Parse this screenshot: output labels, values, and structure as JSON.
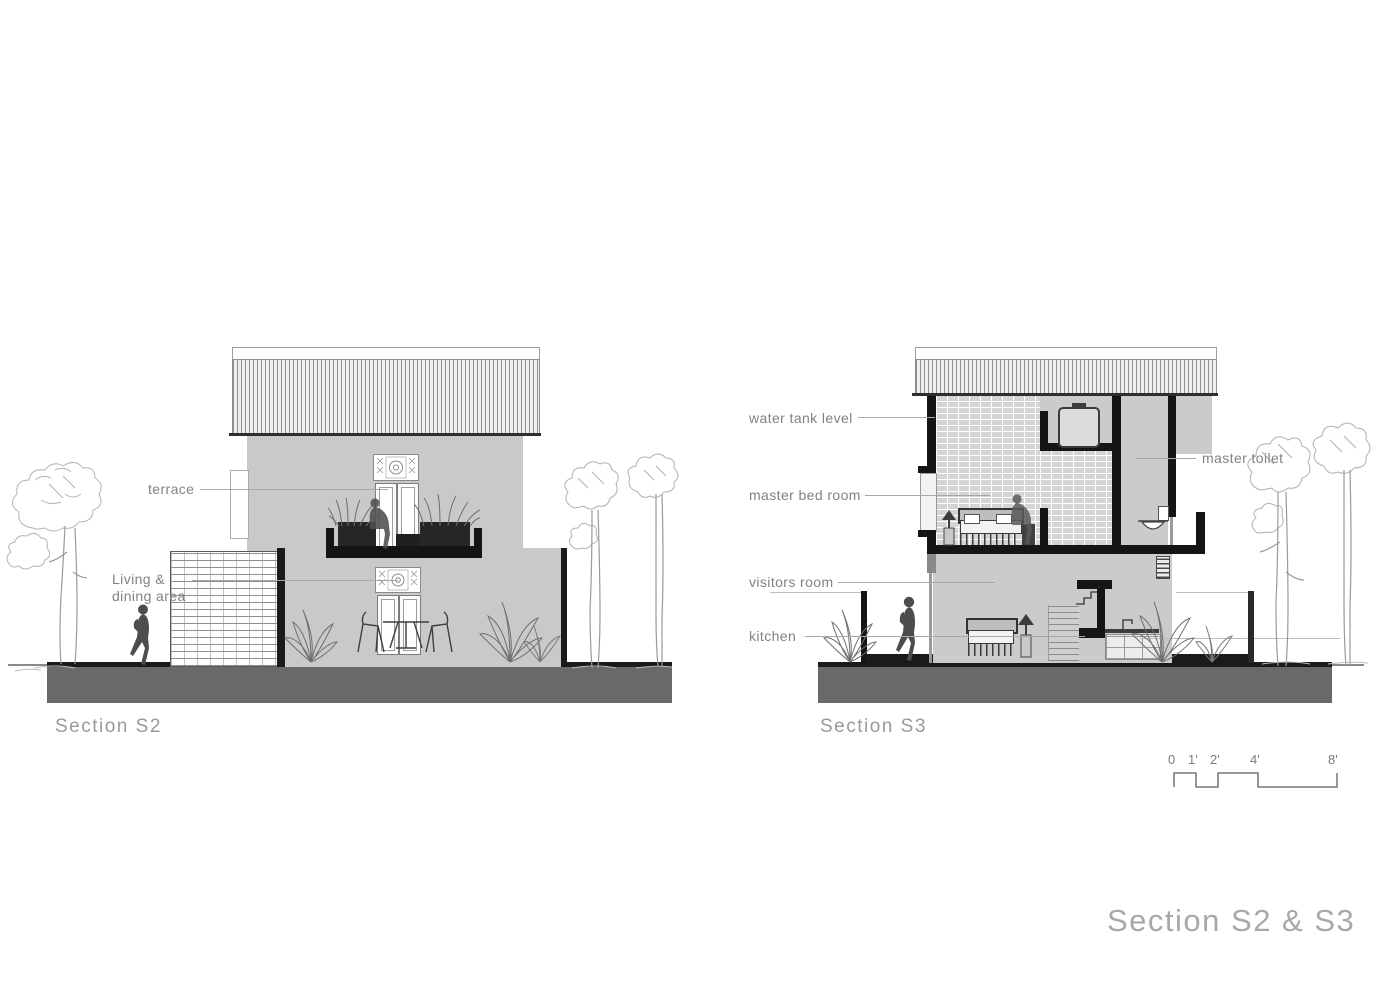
{
  "title": "Section S2 & S3",
  "sections": {
    "s2": {
      "caption": "Section S2",
      "labels": {
        "terrace": "terrace",
        "living_line1": "Living &",
        "living_line2": "dining area"
      }
    },
    "s3": {
      "caption": "Section S3",
      "labels": {
        "water_tank": "water tank level",
        "master_bed": "master bed room",
        "master_toilet": "master toilet",
        "visitors": "visitors room",
        "kitchen": "kitchen"
      }
    }
  },
  "scale_bar": {
    "ticks": [
      "0",
      "1'",
      "2'",
      "4'",
      "8'"
    ]
  },
  "colors": {
    "wall_gray": "#c9c9c9",
    "interior_gray": "#cbcbcb",
    "ground_gray": "#696969",
    "cut_black": "#1a1a1a",
    "label_gray": "#828282",
    "title_gray": "#a8a8a8"
  }
}
